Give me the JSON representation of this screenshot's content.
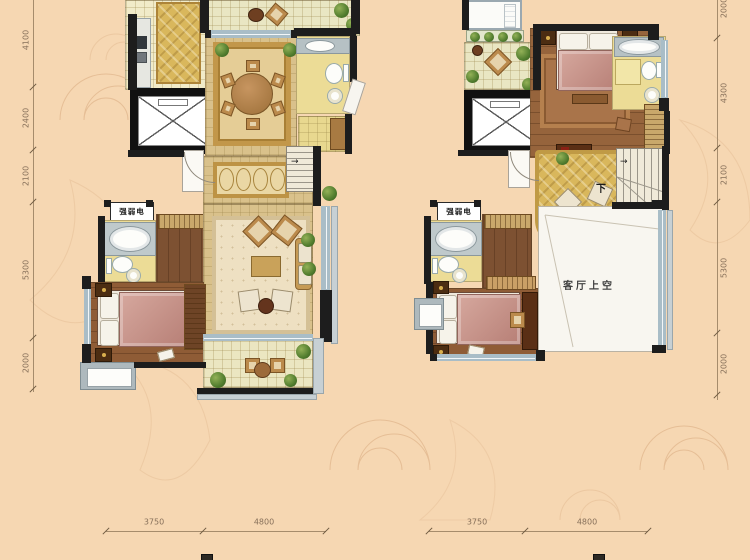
{
  "labels": {
    "weak_power": "强弱电",
    "down": "下",
    "living_void": "客厅上空"
  },
  "dims": {
    "left": [
      "4100",
      "2400",
      "2100",
      "5300",
      "2000"
    ],
    "right": [
      "2000",
      "4300",
      "2100",
      "5300",
      "2000"
    ],
    "bottom_left": [
      "3750",
      "4800"
    ],
    "bottom_right": [
      "3750",
      "4800"
    ]
  },
  "colors": {
    "background": "#f6d7b2",
    "ornament_stroke": "#e0b68c",
    "wall": "#1d1d1d",
    "window": "#a9bdc7",
    "dimension_text": "#87705a",
    "gold_rug": "#d9b75c",
    "wood_floor": "#8f5c36",
    "tile_floor": "#ecdc96",
    "void_area": "#f8f6f0",
    "bed_pink": "#c9958b"
  }
}
